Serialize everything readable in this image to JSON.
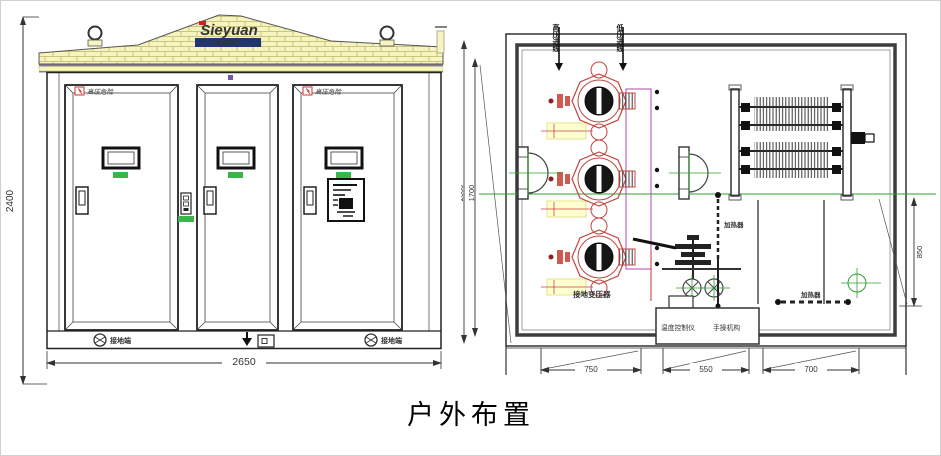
{
  "title": "户外布置",
  "front_view": {
    "brand": "Sieyuan",
    "brand_sub": "思源电气",
    "dim_height": "2400",
    "dim_width": "2650",
    "warning_label": "高压危险",
    "ground_label_left": "接地端",
    "ground_label_right": "接地端"
  },
  "plan_view": {
    "top_label_left": "高压进线",
    "top_label_right": "低压进线",
    "transformer_label": "接地变压器",
    "heater_label_vertical": "加热器",
    "heater_label_horizontal": "加热器",
    "control_label_left": "温度控制仪",
    "control_label_right": "手操机构",
    "dim_outer_height": "2000",
    "dim_inner_height": "1700",
    "dim_right": "850",
    "dim_bottom_left": "750",
    "dim_bottom_middle": "550",
    "dim_bottom_right": "700"
  },
  "colors": {
    "roof_yellow": "#f7f4c0",
    "accent_green": "#3bb54a",
    "drawing_red": "#c2453f",
    "centerline_green": "#2ea12e",
    "logo_navy": "#1b2a6b",
    "warning_red": "#cc3333"
  }
}
